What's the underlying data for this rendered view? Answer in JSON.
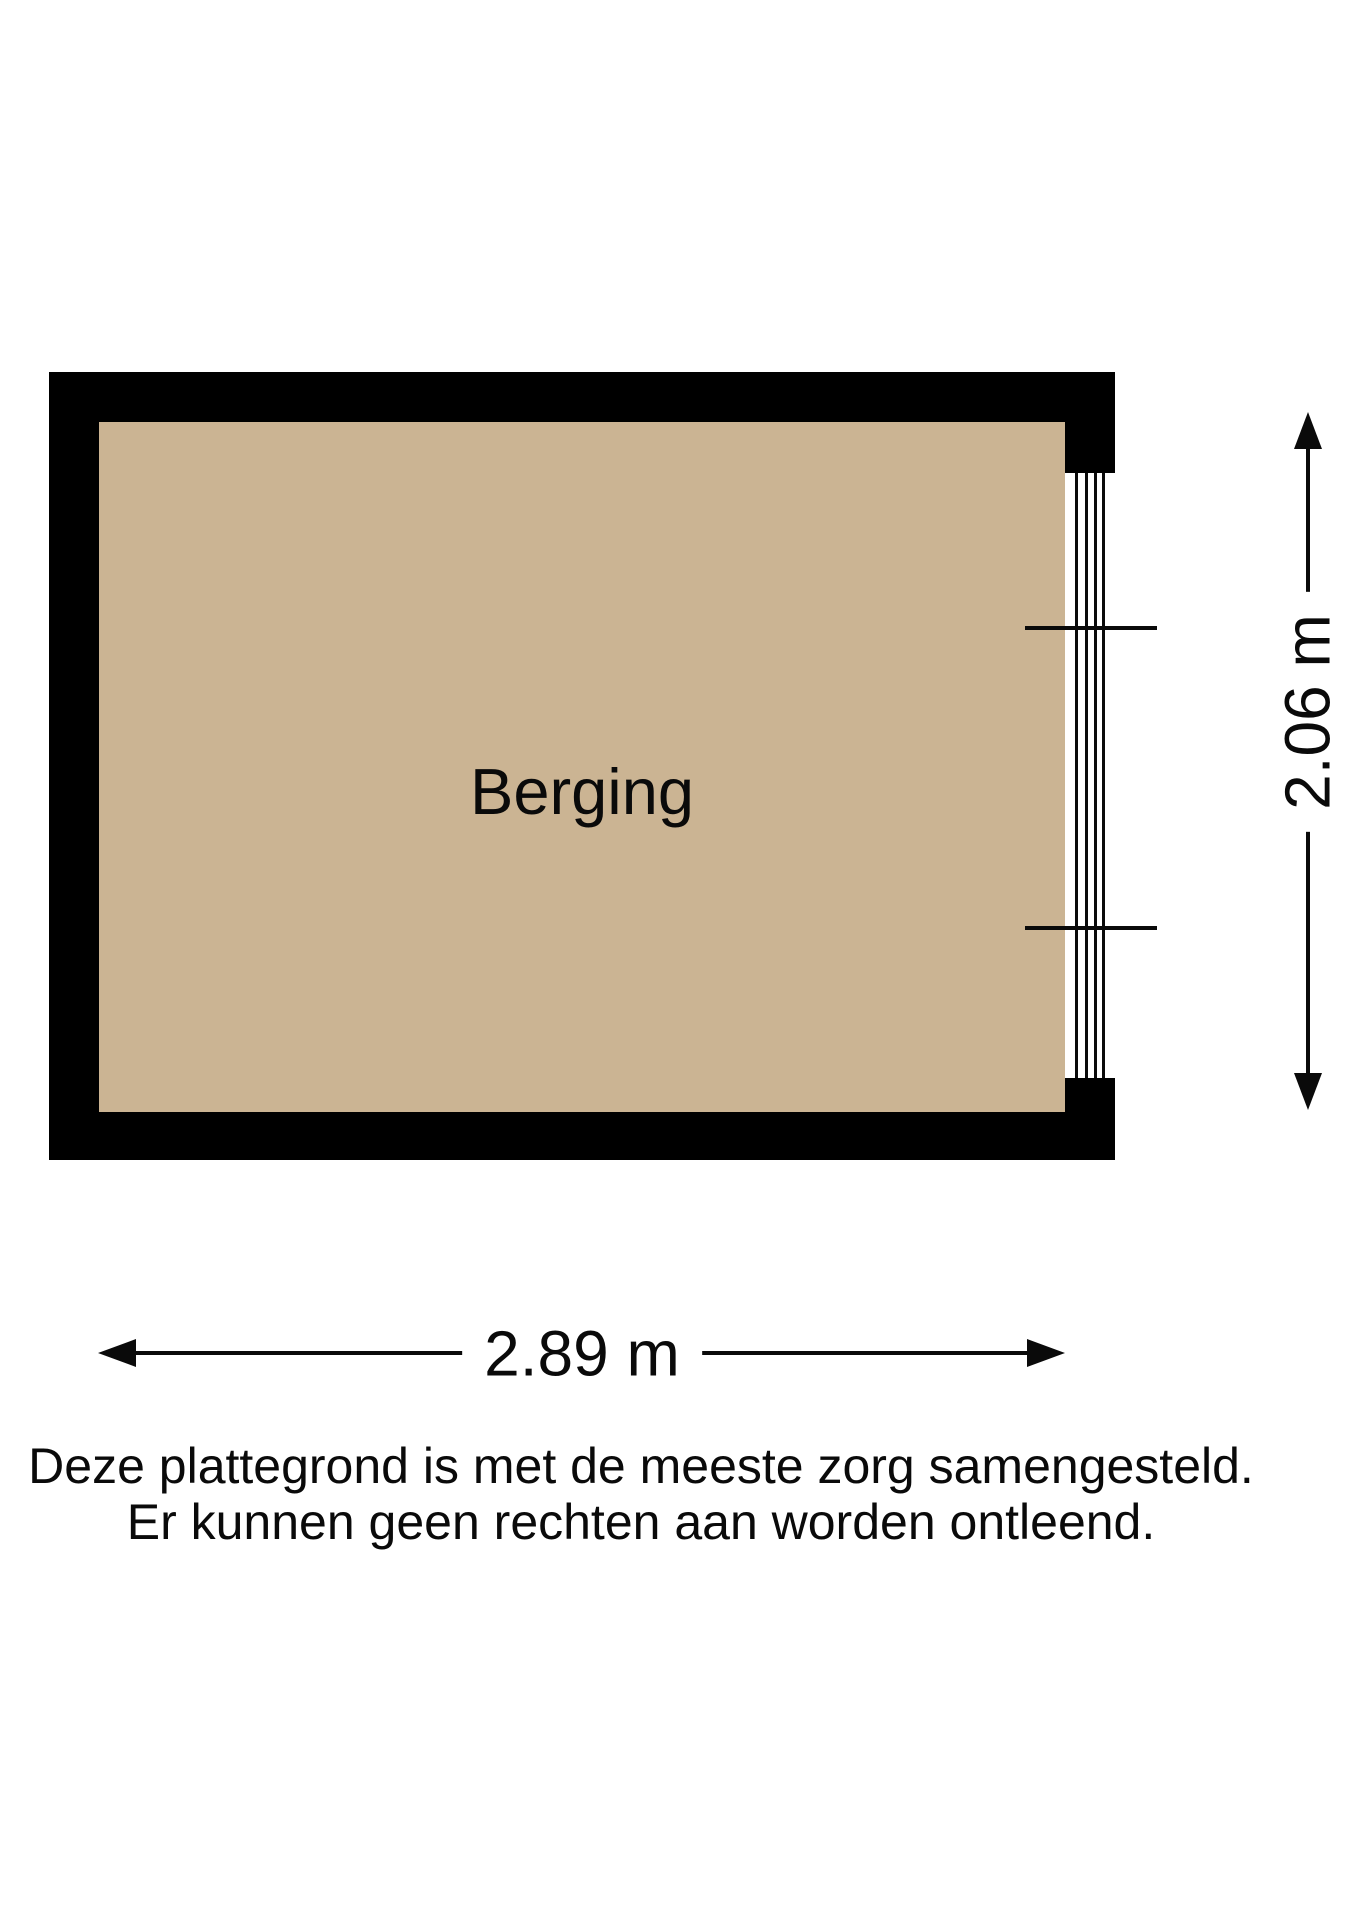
{
  "page": {
    "background": "#FFFFFF"
  },
  "floorplan": {
    "room": {
      "label": "Berging"
    },
    "dimensions": {
      "width": {
        "label": "2.89 m"
      },
      "height": {
        "label": "2.06 m"
      }
    },
    "colors": {
      "wall": "#000000",
      "floor": "#CBB493",
      "line": "#0A0A0A"
    }
  },
  "disclaimer": {
    "line1": "Deze plattegrond is met de meeste zorg samengesteld.",
    "line2": "Er kunnen geen rechten aan worden ontleend."
  }
}
